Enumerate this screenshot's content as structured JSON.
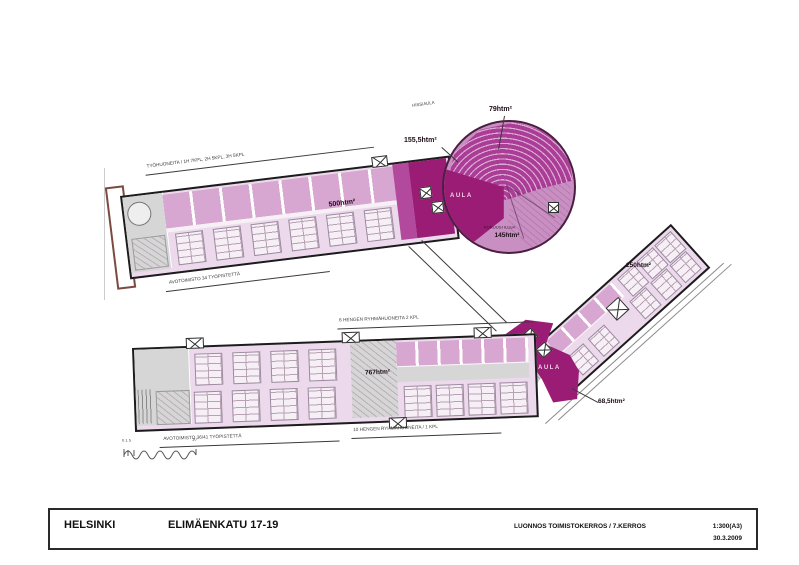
{
  "title_block": {
    "city": "HELSINKI",
    "address": "ELIMÄENKATU 17-19",
    "drawing_title": "LUONNOS TOIMISTOKERROS / 7.KERROS",
    "scale": "1:300(A3)",
    "date": "30.3.2009"
  },
  "plan": {
    "north_wing": {
      "area_label": "500htm²",
      "rooms_note": "TYÖHUONEITA / 1H 7KPL, 2H 5KPL, 3H 5KPL",
      "open_office_note": "AVOTOIMISTO 34 TYÖPISTETTÄ"
    },
    "rotunda": {
      "auditorium_area": "79htm²",
      "core_area": "155,5htm²",
      "lobby": "AULA",
      "meeting_note": "KOKOUSTILOJA",
      "meeting_area": "145htm²",
      "elevator_note": "HISSIAULA"
    },
    "east_wing": {
      "area_label": "250htm²",
      "terrace_area": "68,5htm²"
    },
    "south_wing": {
      "area_label": "767htm²",
      "lobby": "AULA",
      "group_rooms_note": "6 HENGEN RYHMÄHUONEITA 2 KPL",
      "open_office_note": "AVOTOIMISTO 36/41 TYÖPISTETTÄ",
      "group_rooms_note_2": "10 HENGEN RYHMÄHUONEITA / 1 KPL"
    },
    "scale_bar": {
      "left_ticks": "0 1 5",
      "right_tick": "10"
    }
  }
}
